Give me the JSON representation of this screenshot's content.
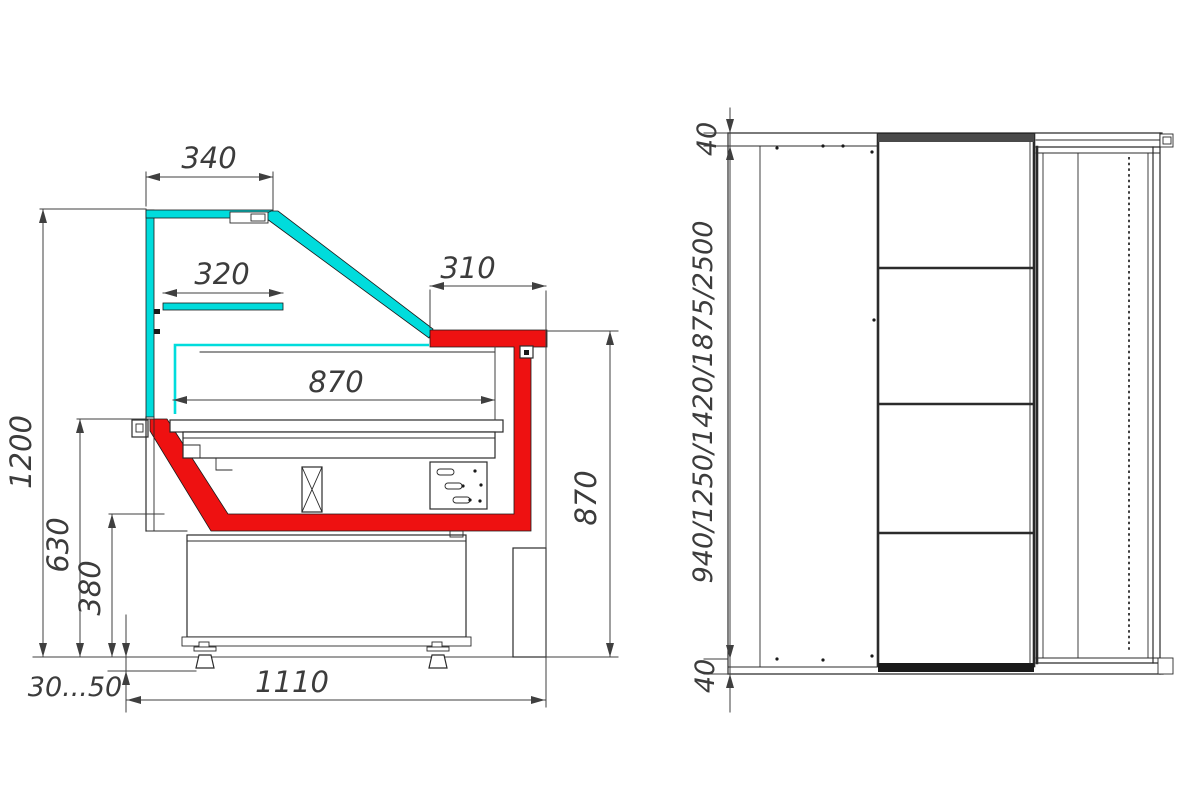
{
  "colors": {
    "glass": "#00dcdc",
    "highlight": "#ee1111",
    "line": "#2b2b2b",
    "dim": "#3f3f3f",
    "bg": "#ffffff"
  },
  "side_view": {
    "name": "Side section view of display case",
    "dims": {
      "canopy_width": "340",
      "shelf_width": "320",
      "rear_overhang": "310",
      "display_depth": "870",
      "overall_height": "1200",
      "front_height": "630",
      "base_height": "380",
      "leg_adjust": "30...50",
      "base_depth": "1110",
      "rear_height": "870"
    }
  },
  "rear_view": {
    "name": "Rear elevation view of display case",
    "dims": {
      "top_panel": "40",
      "bottom_panel": "40",
      "case_lengths": "940/1250/1420/1875/2500"
    }
  }
}
